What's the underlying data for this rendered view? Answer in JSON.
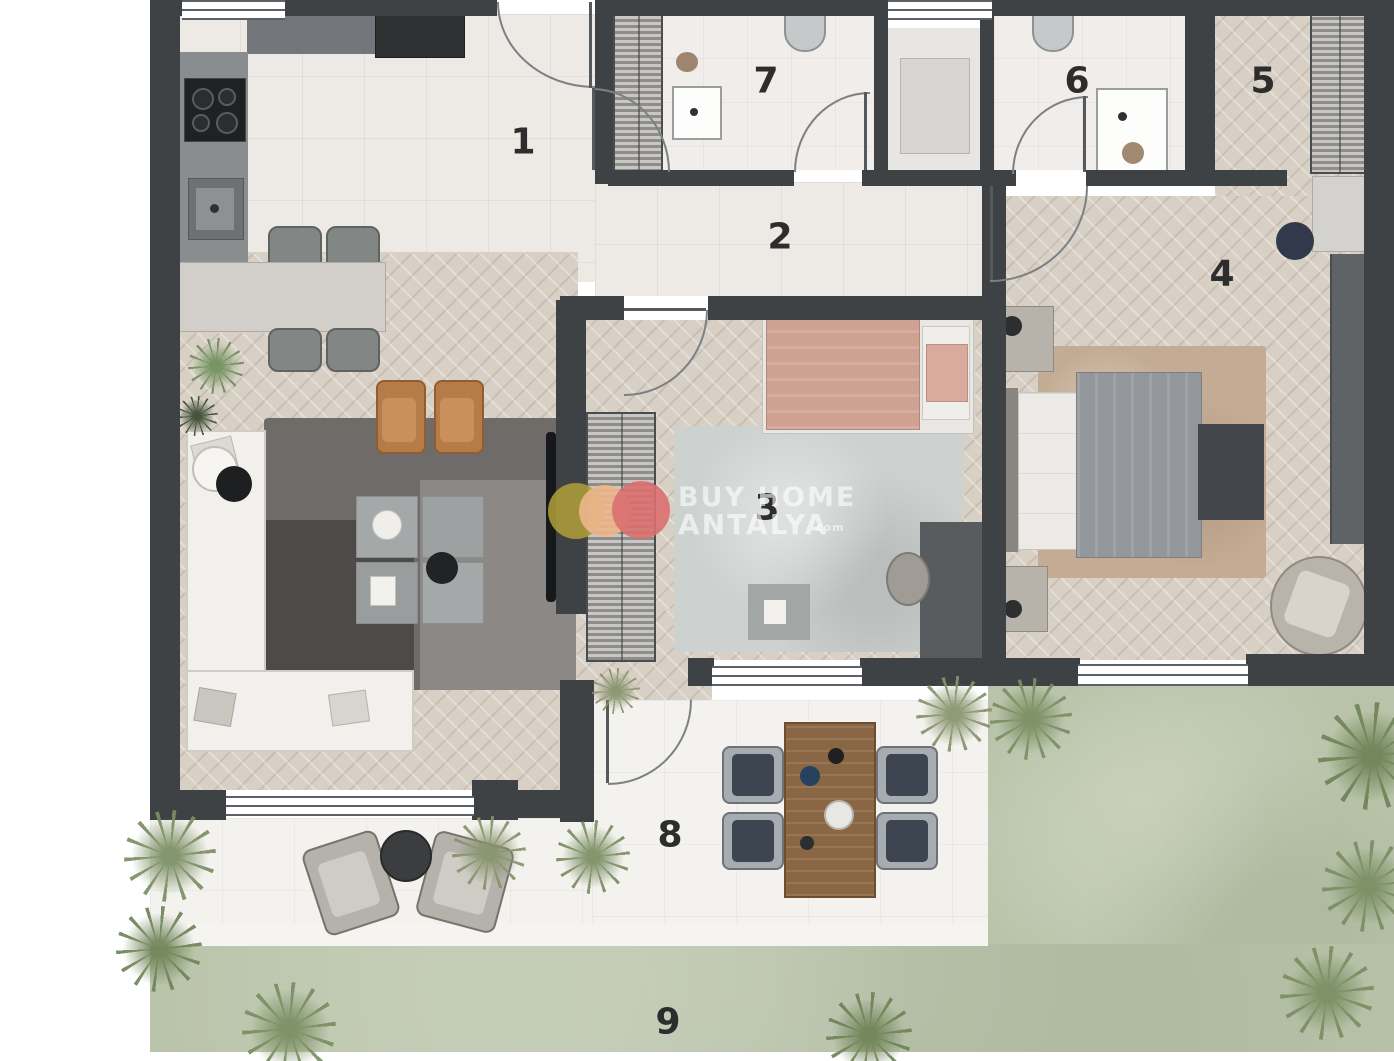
{
  "watermark": {
    "line1": "BUY HOME",
    "line2": "ANTALYA",
    "suffix": "com"
  },
  "rooms": [
    {
      "number": "1",
      "name": "kitchen-living-room"
    },
    {
      "number": "2",
      "name": "hallway"
    },
    {
      "number": "3",
      "name": "bedroom"
    },
    {
      "number": "4",
      "name": "master-bedroom"
    },
    {
      "number": "5",
      "name": "entry-hall"
    },
    {
      "number": "6",
      "name": "bathroom-ensuite"
    },
    {
      "number": "7",
      "name": "bathroom"
    },
    {
      "number": "8",
      "name": "terrace"
    },
    {
      "number": "9",
      "name": "garden"
    }
  ],
  "colors": {
    "wall": "#3f4244",
    "wood_floor": "#d8d0c5",
    "tile_floor": "#edeae5",
    "terrace_floor": "#f4f2ee",
    "garden": "#b9c3a9",
    "logo_circle_olive": "#b0a039",
    "logo_circle_peach": "#ecb68c",
    "logo_circle_red": "#da6f6f"
  }
}
